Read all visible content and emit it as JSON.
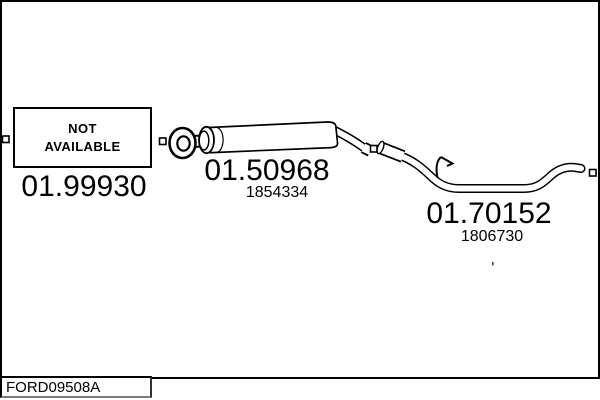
{
  "diagram": {
    "background": "#ffffff",
    "line_color": "#000000",
    "catalog_code": "FORD09508A",
    "not_available_label": {
      "line1": "NOT",
      "line2": "AVAILABLE"
    },
    "parts": [
      {
        "item": "front-section",
        "part_number": "01.99930",
        "reference": ""
      },
      {
        "item": "centre-silencer",
        "part_number": "01.50968",
        "reference": "1854334"
      },
      {
        "item": "rear-pipe",
        "part_number": "01.70152",
        "reference": "1806730"
      }
    ]
  }
}
